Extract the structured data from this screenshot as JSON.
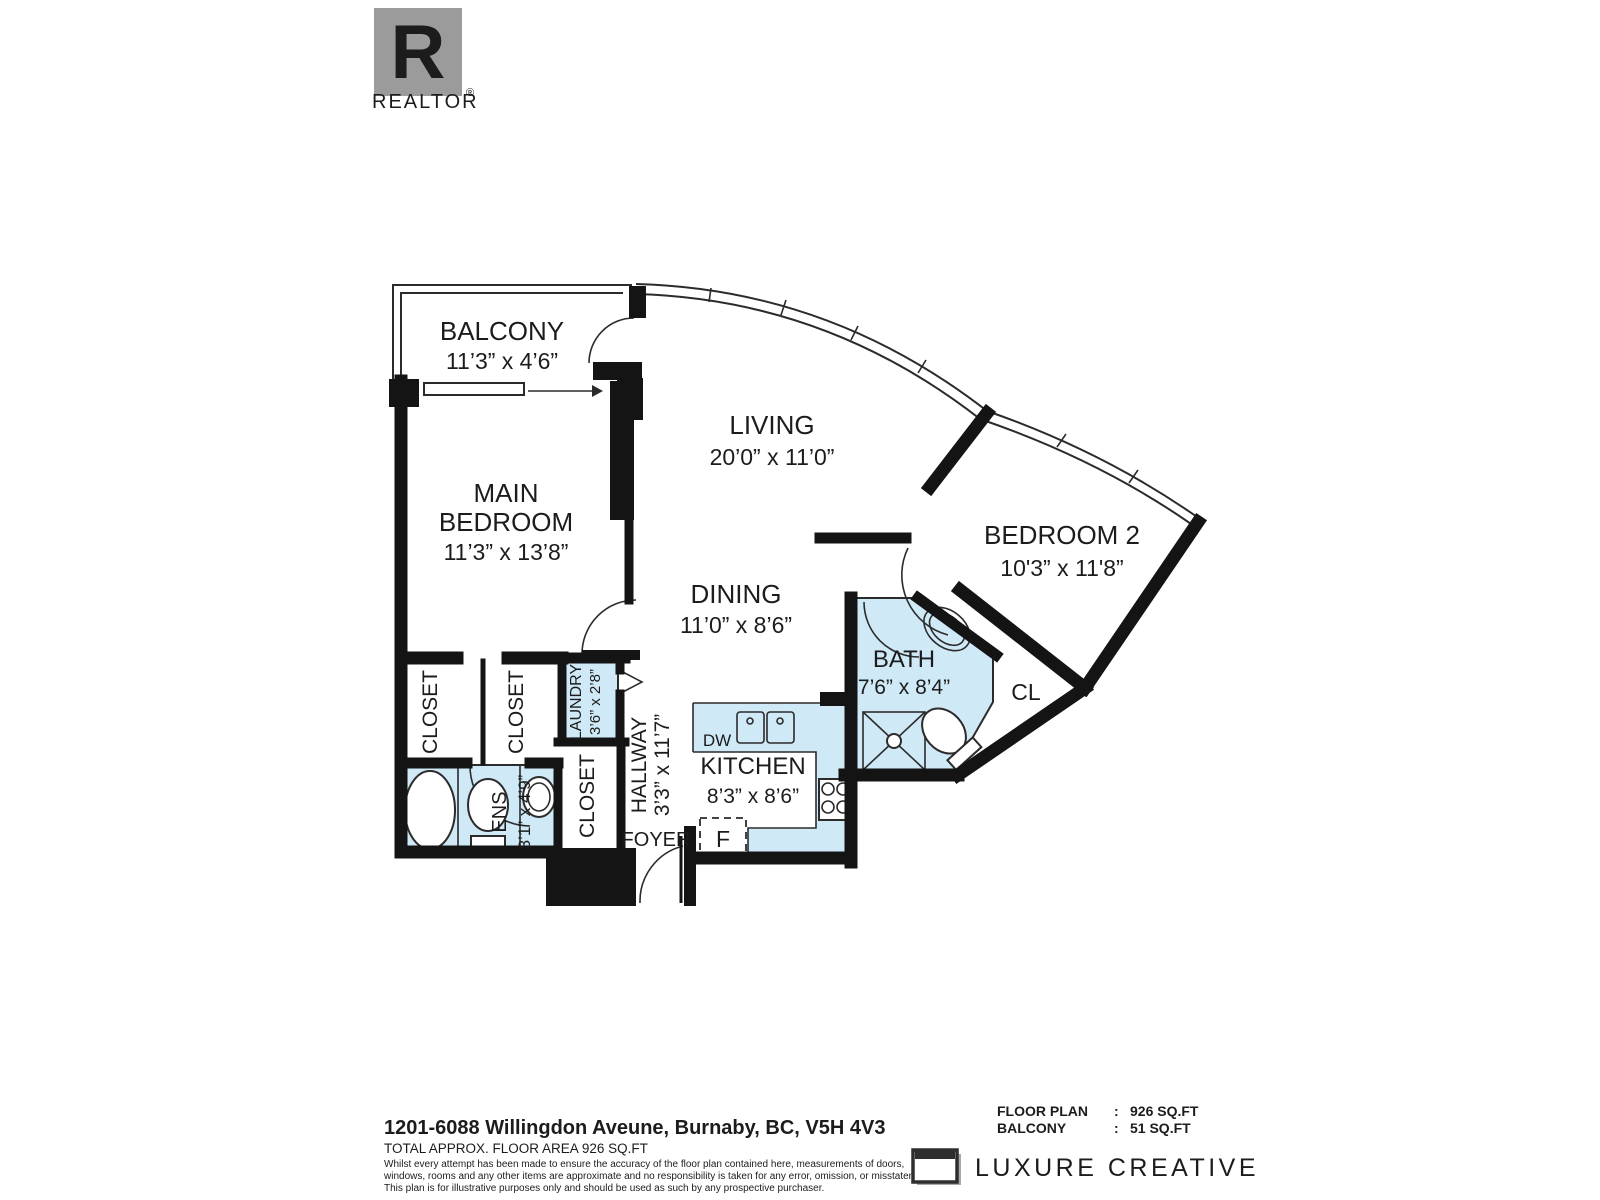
{
  "branding": {
    "realtor_logo_letter": "R",
    "realtor_logo_text": "REALTOR",
    "realtor_reg_mark": "®",
    "company_name": "LUXURE CREATIVE"
  },
  "rooms": {
    "balcony": {
      "name": "BALCONY",
      "dims": "11’3” x 4’6”"
    },
    "living": {
      "name": "LIVING",
      "dims": "20’0” x 11’0”"
    },
    "main_bedroom": {
      "name_line1": "MAIN",
      "name_line2": "BEDROOM",
      "dims": "11’3” x 13’8”"
    },
    "bedroom2": {
      "name": "BEDROOM 2",
      "dims": "10'3” x 11'8”"
    },
    "dining": {
      "name": "DINING",
      "dims": "11’0” x 8’6”"
    },
    "bath": {
      "name": "BATH",
      "dims": "7’6” x 8’4”"
    },
    "kitchen": {
      "name": "KITCHEN",
      "dims": "8’3” x 8’6”"
    },
    "hallway": {
      "name": "HALLWAY",
      "dims": "3’3” x 11’7”"
    },
    "laundry": {
      "name": "LAUNDRY",
      "dims": "3’6” x 2’8”"
    },
    "ensuite": {
      "name": "ENS",
      "dims": "8’1” x 4’9”"
    },
    "foyer": {
      "name": "FOYER"
    },
    "closet_main_1": {
      "name": "CLOSET"
    },
    "closet_main_2": {
      "name": "CLOSET"
    },
    "closet_hall": {
      "name": "CLOSET"
    },
    "closet_bedroom2": {
      "name": "CL"
    }
  },
  "appliances": {
    "dishwasher": "DW",
    "fridge": "F"
  },
  "footer": {
    "address": "1201-6088 Willingdon Aveune, Burnaby, BC, V5H 4V3",
    "total_area": "TOTAL APPROX. FLOOR AREA 926 SQ.FT",
    "disclaimer_line1": "Whilst every attempt has been made to ensure the accuracy of the floor plan contained here, measurements of doors,",
    "disclaimer_line2": "windows, rooms and any other items are approximate and no responsibility is taken for any error, omission, or misstatement.",
    "disclaimer_line3": "This plan is for illustrative purposes only and should be used as such by any prospective purchaser.",
    "areas": [
      {
        "label": "FLOOR PLAN",
        "sep": ":",
        "value": "926 SQ.FT"
      },
      {
        "label": "BALCONY",
        "sep": ":",
        "value": "51 SQ.FT"
      }
    ]
  },
  "colors": {
    "wall": "#141414",
    "wet_area": "#cfe9f7",
    "logo_gray": "#9b9b9b",
    "logo_dark": "#2e2e2e"
  }
}
